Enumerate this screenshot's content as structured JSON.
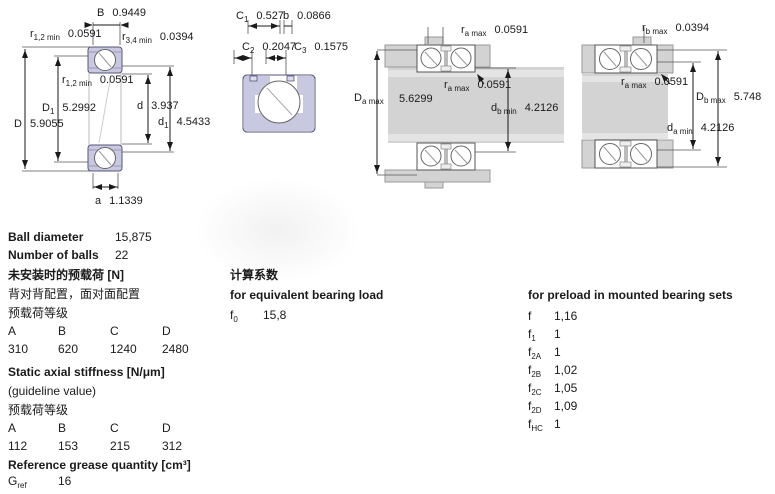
{
  "colors": {
    "ring_fill": "#c8c8e0",
    "housing_gray": "#d3d3d3",
    "line": "#1a1a1a"
  },
  "diagrams": {
    "d1": {
      "B": {
        "base": "B",
        "value": "0.9449"
      },
      "r12_top": {
        "base": "r",
        "sub": "1,2 min",
        "value": "0.0591"
      },
      "r34": {
        "base": "r",
        "sub": "3,4 min",
        "value": "0.0394"
      },
      "r12_inner": {
        "base": "r",
        "sub": "1,2 min",
        "value": "0.0591"
      },
      "D1": {
        "base": "D",
        "sub": "1",
        "value": "5.2992"
      },
      "D": {
        "base": "D",
        "value": "5.9055"
      },
      "d": {
        "base": "d",
        "value": "3.937"
      },
      "d1": {
        "base": "d",
        "sub": "1",
        "value": "4.5433"
      },
      "a": {
        "base": "a",
        "value": "1.1339"
      }
    },
    "d2": {
      "C1": {
        "base": "C",
        "sub": "1",
        "value": "0.527"
      },
      "b": {
        "base": "b",
        "value": "0.0866"
      },
      "C2": {
        "base": "C",
        "sub": "2",
        "value": "0.2047"
      },
      "C3": {
        "base": "C",
        "sub": "3",
        "value": "0.1575"
      }
    },
    "d3": {
      "ra_top": {
        "base": "r",
        "sub": "a max",
        "value": "0.0591"
      },
      "Da": {
        "base": "D",
        "sub": "a max",
        "value": "5.6299"
      },
      "ra_mid": {
        "base": "r",
        "sub": "a max",
        "value": "0.0591"
      },
      "db": {
        "base": "d",
        "sub": "b min",
        "value": "4.2126"
      }
    },
    "d4": {
      "rb_top": {
        "base": "r",
        "sub": "b max",
        "value": "0.0394"
      },
      "ra_mid": {
        "base": "r",
        "sub": "a max",
        "value": "0.0591"
      },
      "Db": {
        "base": "D",
        "sub": "b max",
        "value": "5.748"
      },
      "da": {
        "base": "d",
        "sub": "a min",
        "value": "4.2126"
      }
    }
  },
  "specs": {
    "ball_diameter_label": "Ball diameter",
    "ball_diameter_value": "15,875",
    "number_of_balls_label": "Number of balls",
    "number_of_balls_value": "22",
    "preload_heading": "未安装时的预载荷 [N]",
    "preload_sub1": "背对背配置，面对面配置",
    "preload_sub2": "预载荷等级",
    "preload_classes": [
      "A",
      "B",
      "C",
      "D"
    ],
    "preload_values": [
      "310",
      "620",
      "1240",
      "2480"
    ],
    "stiffness_heading": "Static axial stiffness [N/μm]",
    "stiffness_sub1": "(guideline value)",
    "stiffness_sub2": "预载荷等级",
    "stiffness_classes": [
      "A",
      "B",
      "C",
      "D"
    ],
    "stiffness_values": [
      "112",
      "153",
      "215",
      "312"
    ],
    "grease_heading": "Reference grease quantity [cm³]",
    "grease_symbol": {
      "base": "G",
      "sub": "ref"
    },
    "grease_value": "16"
  },
  "factors": {
    "calc_heading": "计算系数",
    "equivalent_heading": "for equivalent bearing load",
    "f0": {
      "base": "f",
      "sub": "0",
      "value": "15,8"
    },
    "preload_heading": "for preload in mounted bearing sets",
    "rows": [
      {
        "base": "f",
        "sub": "",
        "value": "1,16"
      },
      {
        "base": "f",
        "sub": "1",
        "value": "1"
      },
      {
        "base": "f",
        "sub": "2A",
        "value": "1"
      },
      {
        "base": "f",
        "sub": "2B",
        "value": "1,02"
      },
      {
        "base": "f",
        "sub": "2C",
        "value": "1,05"
      },
      {
        "base": "f",
        "sub": "2D",
        "value": "1,09"
      },
      {
        "base": "f",
        "sub": "HC",
        "value": "1"
      }
    ]
  }
}
